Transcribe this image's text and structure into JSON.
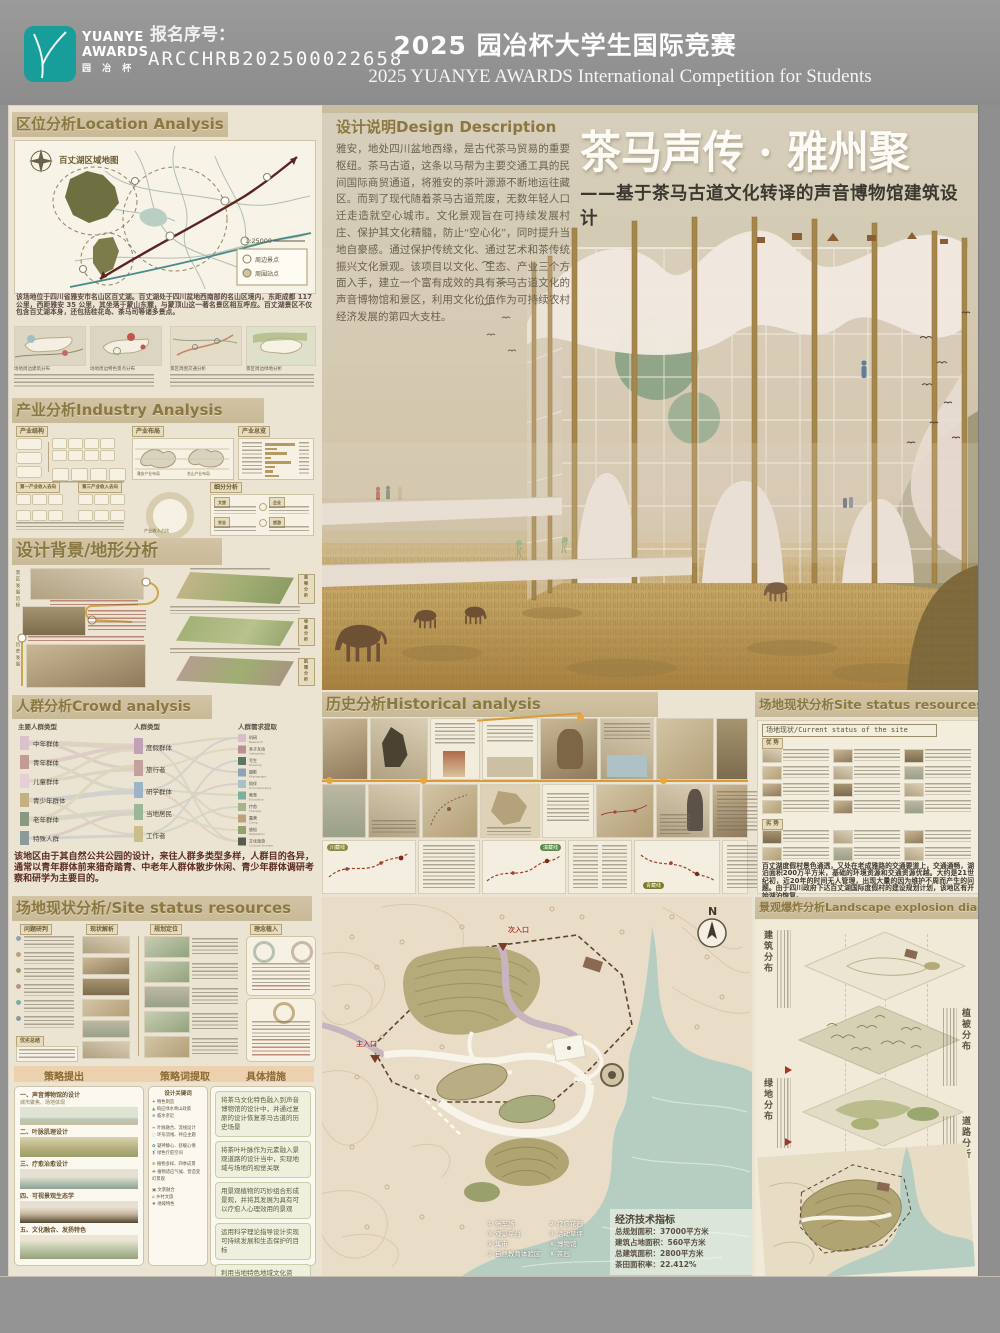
{
  "header": {
    "logo": {
      "line1": "YUANYE",
      "line2": "AWARDS",
      "line3": "园 冶 杯"
    },
    "reg_label": "报名序号：",
    "reg_number": "ARCCHRB202500022658",
    "title_cn": "2025 园冶杯大学生国际竞赛",
    "title_en": "2025 YUANYE AWARDS International Competition for  Students"
  },
  "colors": {
    "accent_teal": "#179e9b",
    "band_bg": "#cdbf9e",
    "band_text": "#8b7840",
    "poster_bg": "#ebe4d3"
  },
  "location": {
    "title": "区位分析Location Analysis",
    "map_label": "百丈湖区域地图",
    "scale": "1:25000",
    "legend": [
      "周边景点",
      "周围站点"
    ],
    "paragraph": "该场地位于四川省雅安市名山区百丈湖。百丈湖处于四川盆地西南部的名山区境内，东距成都 117 公里，西距雅安 35 公里，其坐落于蒙山东麓，与蒙顶山这一著名景区相互呼应。百丈湖景区不仅包含百丈湖本身，还包括桂花岛、茶马司等诸多景点。",
    "minimap_captions": [
      "场地周边建筑分布",
      "场地周边特色景点分布",
      "景区周围交通分析",
      "景区周边绿地分析"
    ]
  },
  "industry": {
    "title": "产业分析Industry Analysis",
    "panel_labels": [
      "产业结构",
      "产业布局",
      "产业总览",
      "细分分析"
    ],
    "submap_labels": [
      "雅安产业布局",
      "名山产业布局"
    ],
    "income_labels": [
      "第一产业收入去向",
      "第三产业收入去向"
    ],
    "donut_label": "产业收入占比",
    "quadrant_labels": [
      "文旅",
      "企业",
      "农业",
      "旅游"
    ]
  },
  "background": {
    "title": "设计背景/地形分析",
    "timeline_labels": [
      "景区发展历程",
      "历史发展"
    ],
    "terrain_labels": [
      "高程分析",
      "坡度分析",
      "肌理分析"
    ]
  },
  "crowd": {
    "title": "人群分析Crowd analysis",
    "col_headers": [
      "主要人群类型",
      "人群类型",
      "人群需求提取"
    ],
    "groups": [
      "中年群体",
      "青年群体",
      "儿童群体",
      "青少年群体",
      "老年群体",
      "特殊人群"
    ],
    "types": [
      "度假群体",
      "旅行者",
      "研学群体",
      "当地居民",
      "工作者"
    ],
    "needs": [
      {
        "cn": "科研",
        "en": "Research"
      },
      {
        "cn": "亲子互动",
        "en": "Interaction"
      },
      {
        "cn": "写生",
        "en": "Drawing"
      },
      {
        "cn": "摄影",
        "en": "Photograph"
      },
      {
        "cn": "陪伴",
        "en": "Accompanying"
      },
      {
        "cn": "教育",
        "en": "Education"
      },
      {
        "cn": "疗愈",
        "en": "Therapy"
      },
      {
        "cn": "露营",
        "en": "Camp"
      },
      {
        "cn": "放松",
        "en": "Relaxation"
      },
      {
        "cn": "文化旅游",
        "en": "Cultural tourism"
      }
    ],
    "paragraph": "该地区由于其自然公共公园的设计，来往人群多类型多样，人群目的各异，通常以青年群体前来猎奇踏青、中老年人群体散步休闲、青少年群体调研考察和研学为主要目的。"
  },
  "site_left": {
    "title": "场地现状分析/Site status resources",
    "col_headers": [
      "问题研判",
      "现状解析",
      "规划定位",
      "理念植入"
    ],
    "summary_label": "优劣总结",
    "strategy_headers": [
      "策略提出",
      "策略词提取",
      "具体措施"
    ],
    "strategies": [
      {
        "t": "一、声音博物馆的设计",
        "s": "城市聚焦、场地体现"
      },
      {
        "t": "二、叶脉肌理设计",
        "s": ""
      },
      {
        "t": "三、疗愈治愈设计",
        "s": ""
      },
      {
        "t": "四、可视景观生态学",
        "s": ""
      },
      {
        "t": "五、文化融合、发扬特色",
        "s": ""
      }
    ],
    "keywords_title": "设计关键词",
    "keywords": [
      "特色制造",
      "响应绿水青山政策",
      "临水亲近",
      "叶脉融合、流线设计",
      "环形流线、呼应主题",
      "凝神静心、舒缓心情",
      "绿色疗愈空间",
      "植物多样、四季成景",
      "植物适应气候、营造变幻景观",
      "文景融合",
      "乡村文旅",
      "地域特色"
    ],
    "measures": [
      "将茶马文化特色融入到声音博物馆的设计中，并通过复原的设计恢复茶马古道的历史场景",
      "将茶叶叶脉作为元素融入景观道路的设计当中，实现地域与场地的视觉关联",
      "用景观植物的巧妙组合形成景观，并将其发展为具有可以疗愈人心理效用的景观",
      "运用科学理论指导设计实现可持续发展和生态保护的目标",
      "利用当地特色地域文化资产：蒙山茶和气候特色文化“茶马文化”和“雅文化”以不同方式被巧妙引入设计"
    ]
  },
  "description": {
    "title": "设计说明Design Description",
    "paragraph": "雅安，地处四川盆地西缘，是古代茶马贸易的重要枢纽。茶马古道，这条以马帮为主要交通工具的民间国际商贸通道，将雅安的茶叶源源不断地运往藏区。而到了现代随着茶马古道荒废，无数年轻人口迁走造就空心城市。文化景观旨在可持续发展村庄、保护其文化精髓，防止“空心化”，同时提升当地自豪感。通过保护传统文化、通过艺术和茶传统振兴文化景观。该项目以文化、生态、产业三个方面入手，建立一个富有成效的具有茶马古道文化的声音博物馆和景区，利用文化价值作为可持续农村经济发展的第四大支柱。"
  },
  "main_title": {
    "cn": "茶马声传 · 雅州聚",
    "sub": "——基于茶马古道文化转译的声音博物馆建筑设计"
  },
  "history": {
    "title": "历史分析Historical analysis",
    "route_pills": [
      "川藏线",
      "滇藏线",
      "青藏线"
    ]
  },
  "site_right": {
    "title": "场地现状分析Site status resources",
    "bar": "场地现状/Current status of the site",
    "group_pros": "优 势",
    "group_cons": "劣 势",
    "paragraph": "百丈湖度假村景色通透，又处在老成雅路的交通要道上，交通通畅，湖泊面积200万平方米，基础的环境资源和交通资源优越。大约是21世纪初，近20年的时间无人管理，出现大量的因为维护不周而产生的问题。由于四川政府下达百丈湖国际度假村的建设规划计划，该地区有开始湖泊恢复。"
  },
  "masterplan": {
    "north": "N",
    "entrance_secondary": "次入口",
    "entrance_main": "主入口",
    "legend": [
      "① 停车场",
      "② 疗愈花园",
      "③ 观景平台",
      "④ 活动草坪",
      "⑤ 集市",
      "⑥ 博物馆",
      "⑦ 自然教育体验区",
      "⑧ 茶园"
    ],
    "indicators_title": "经济技术指标",
    "indicators": [
      "总规划面积：37000平方米",
      "建筑占地面积：560平方米",
      "总建筑面积：2800平方米",
      "茶田面积率：22.412%"
    ]
  },
  "explosion": {
    "title": "景观爆炸分析Landscape explosion dia-",
    "layers": [
      "建筑分布",
      "植被分布",
      "绿地分布",
      "道路分析"
    ]
  }
}
